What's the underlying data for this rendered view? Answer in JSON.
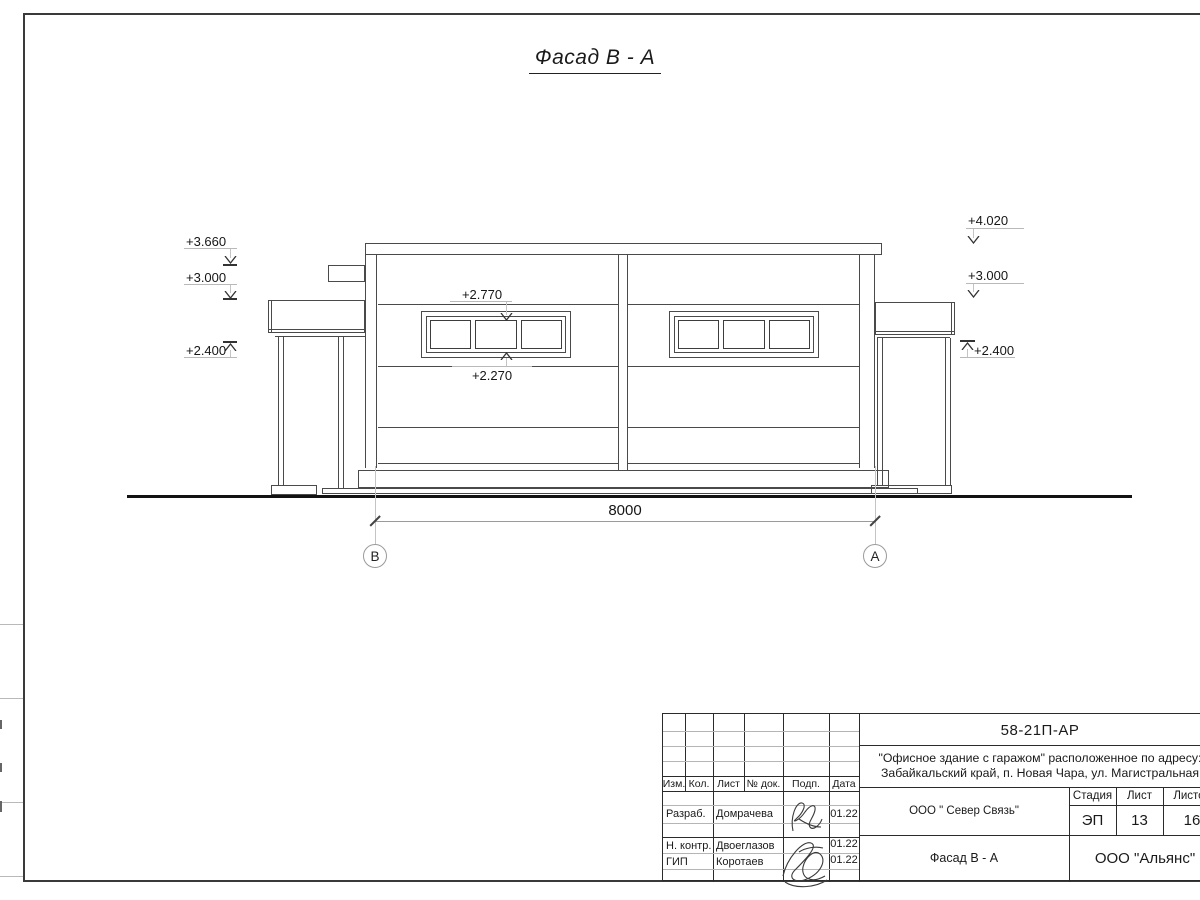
{
  "drawing": {
    "title": "Фасад В - А",
    "dimension": "8000",
    "axis_left": "В",
    "axis_right": "А",
    "marks": {
      "left_3660": "+3.660",
      "left_3000": "+3.000",
      "left_2400": "+2.400",
      "right_4020": "+4.020",
      "right_3000": "+3.000",
      "right_2400": "+2.400",
      "win_top": "+2.770",
      "win_bottom": "+2.270"
    }
  },
  "title_block": {
    "code": "58-21П-АР",
    "project_line1": "\"Офисное здание с гаражом\" расположенное по адресу:",
    "project_line2": "Забайкальский край, п. Новая Чара, ул. Магистральная",
    "client": "ООО \" Север Связь\"",
    "stage_label": "Стадия",
    "sheet_label": "Лист",
    "sheets_label": "Листов",
    "stage": "ЭП",
    "sheet": "13",
    "sheets": "16",
    "drawing_name": "Фасад В - А",
    "company": "ООО \"Альянс\"",
    "col_headers": [
      "Изм.",
      "Кол.",
      "Лист",
      "№ док.",
      "Подп.",
      "Дата"
    ],
    "rows": [
      {
        "role": "Разраб.",
        "name": "Домрачева",
        "date": "01.22"
      },
      {
        "role": "Н. контр.",
        "name": "Двоеглазов",
        "date": "01.22"
      },
      {
        "role": "ГИП",
        "name": "Коротаев",
        "date": "01.22"
      }
    ]
  }
}
